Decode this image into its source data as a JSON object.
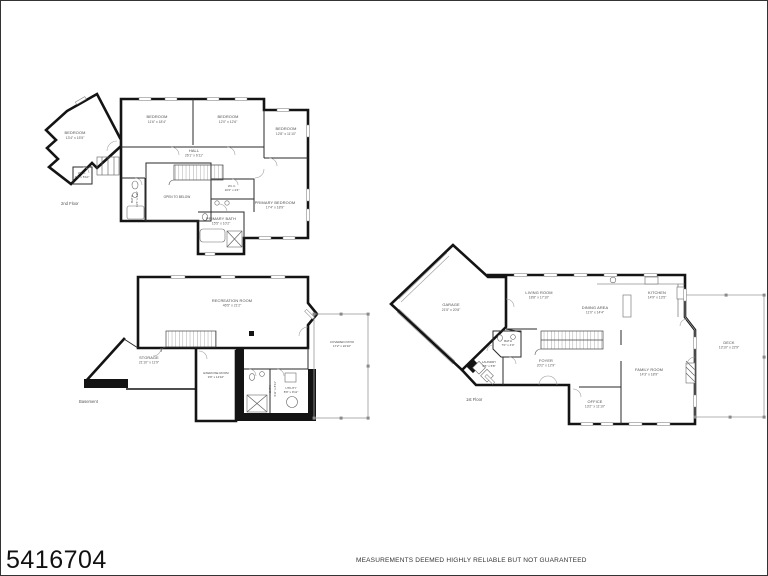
{
  "page": {
    "listing_id": "5416704",
    "disclaimer": "MEASUREMENTS DEEMED HIGHLY RELIABLE BUT NOT GUARANTEED",
    "background": "#ffffff",
    "line_color": "#141414"
  },
  "floor2": {
    "label": "2nd Floor",
    "rooms": {
      "bedroom_wing": {
        "name": "BEDROOM",
        "dims": "13'4\" x 15'5\""
      },
      "bedroom_1": {
        "name": "BEDROOM",
        "dims": "11'6\" x 18'4\""
      },
      "bedroom_2": {
        "name": "BEDROOM",
        "dims": "12'0\" x 12'6\""
      },
      "bedroom_3": {
        "name": "BEDROOM",
        "dims": "12'8\" x 11'10\""
      },
      "hall": {
        "name": "HALL",
        "dims": "26'1\" x 6'11\""
      },
      "open_to_below": {
        "name": "OPEN TO BELOW"
      },
      "wic_small": {
        "name": "W.I.C.",
        "dims": "4'6\" x 5'10\""
      },
      "bath": {
        "name": "BATH",
        "dims": "11'6\" x 4'11\""
      },
      "wic": {
        "name": "W.I.C.",
        "dims": "10'2\" x 4'4\""
      },
      "primary_bedroom": {
        "name": "PRIMARY BEDROOM",
        "dims": "17'4\" x 18'9\""
      },
      "primary_bath": {
        "name": "PRIMARY BATH",
        "dims": "15'5\" x 10'2\""
      }
    }
  },
  "basement": {
    "label": "Basement",
    "rooms": {
      "recreation_room": {
        "name": "RECREATION ROOM",
        "dims": "46'5\" x 21'2\""
      },
      "storage": {
        "name": "STORAGE",
        "dims": "21'10\" x 11'9\""
      },
      "exercise_room": {
        "name": "EXERCISE ROOM",
        "dims": "9'9\" x 14'10\""
      },
      "bath": {
        "name": "BATH",
        "dims": "4'11\" x 8'11\""
      },
      "utility": {
        "name": "UTILITY",
        "dims": "8'9\" x 9'11\""
      },
      "covered_patio": {
        "name": "COVERED PATIO",
        "dims": "17'2\" x 22'10\""
      }
    }
  },
  "floor1": {
    "label": "1st Floor",
    "rooms": {
      "garage": {
        "name": "GARAGE",
        "dims": "21'5\" x 20'8\""
      },
      "living_room": {
        "name": "LIVING ROOM",
        "dims": "18'8\" x 17'10\""
      },
      "dining_area": {
        "name": "DINING AREA",
        "dims": "11'0\" x 14'4\""
      },
      "kitchen": {
        "name": "KITCHEN",
        "dims": "14'9\" x 13'5\""
      },
      "foyer": {
        "name": "FOYER",
        "dims": "20'2\" x 12'9\""
      },
      "bath": {
        "name": "BATH",
        "dims": "7'0\" x 4'0\""
      },
      "laundry": {
        "name": "LAUNDRY",
        "dims": "6'5\" x 5'8\""
      },
      "family_room": {
        "name": "FAMILY ROOM",
        "dims": "14'3\" x 18'9\""
      },
      "office": {
        "name": "OFFICE",
        "dims": "13'2\" x 11'10\""
      },
      "deck": {
        "name": "DECK",
        "dims": "13'10\" x 22'9\""
      }
    }
  }
}
